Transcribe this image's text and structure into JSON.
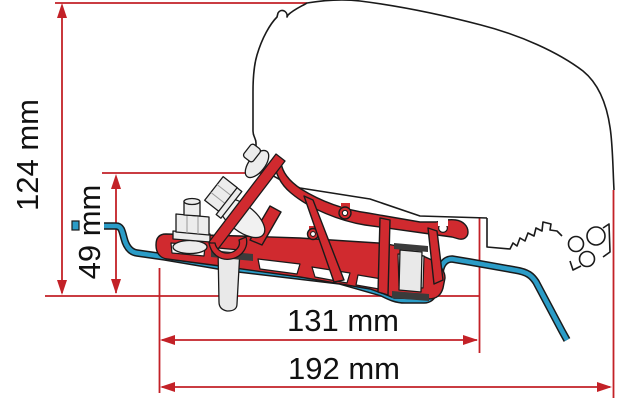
{
  "diagram": {
    "type": "technical-drawing",
    "subject": "awning-roof-adapter-bracket-side-profile",
    "dimensions": [
      {
        "name": "overall-height",
        "label": "124 mm",
        "orientation": "vertical"
      },
      {
        "name": "bracket-height",
        "label": "49 mm",
        "orientation": "vertical"
      },
      {
        "name": "bracket-width",
        "label": "131 mm",
        "orientation": "horizontal"
      },
      {
        "name": "overall-width",
        "label": "192 mm",
        "orientation": "horizontal"
      }
    ],
    "colors": {
      "dimension_lines": "#c32127",
      "bracket": "#d02a2f",
      "roof_sheet": "#2b9cc7",
      "vehicle_outline": "#1a1a1a",
      "hardware": "#e9e9e9",
      "rubber_pad": "#3b3b3b",
      "background": "#ffffff"
    },
    "parts": [
      "vehicle-body-outline",
      "roof-sheet-profile",
      "adapter-bracket",
      "mounting-bolts"
    ]
  }
}
